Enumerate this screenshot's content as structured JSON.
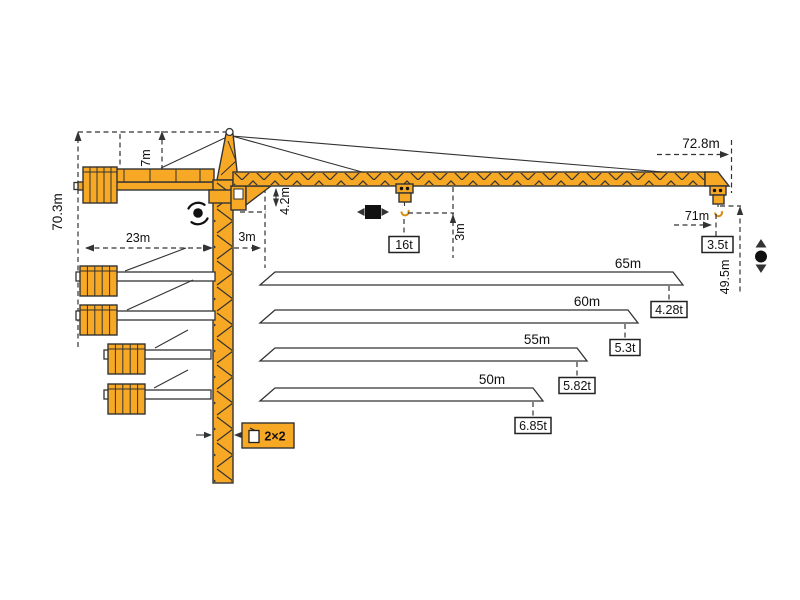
{
  "colors": {
    "crane_orange": "#F7A824",
    "outline": "#333333",
    "background": "#FFFFFF"
  },
  "crane": {
    "total_height": "70.3m",
    "apex_height": "7m",
    "counterjib_radius": "23m",
    "min_radius": "3m",
    "jib_root_depth": "4.2m",
    "hook_clearance": "3m",
    "max_capacity": "16t",
    "max_radius": "72.8m",
    "tip_hook_radius": "71m",
    "tip_capacity": "3.5t",
    "tip_hook_height": "49.5m",
    "mast_section": "2×2"
  },
  "jib_options": [
    {
      "length": "65m",
      "tip_capacity": "4.28t"
    },
    {
      "length": "60m",
      "tip_capacity": "5.3t"
    },
    {
      "length": "55m",
      "tip_capacity": "5.82t"
    },
    {
      "length": "50m",
      "tip_capacity": "6.85t"
    }
  ],
  "icons": {
    "slewing": "rotation-arrows-around-dot",
    "trolley_travel": "square-with-left-right-arrows",
    "hoist": "dot-with-up-down-arrows"
  }
}
